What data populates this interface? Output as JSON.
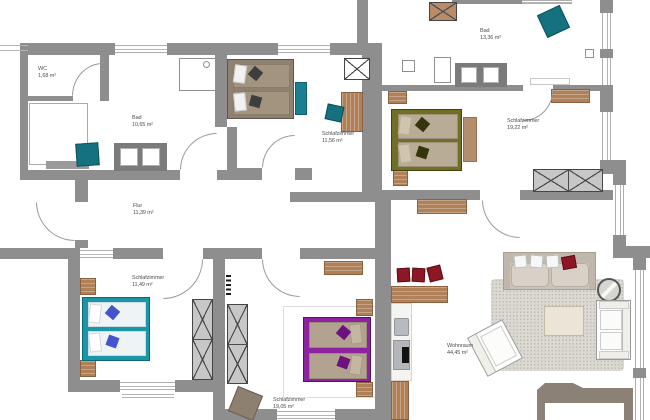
{
  "rooms": {
    "wc": {
      "name": "WC",
      "area": "1,68 m²"
    },
    "bad_left": {
      "name": "Bad",
      "area": "10,65 m²"
    },
    "schlaf_top": {
      "name": "Schlafzimmer",
      "area": "11,56 m²"
    },
    "flur": {
      "name": "Flur",
      "area": "11,39 m²"
    },
    "schlaf_bl": {
      "name": "Schlafzimmer",
      "area": "11,49 m²"
    },
    "schlaf_bm": {
      "name": "Schlafzimmer",
      "area": "19,05 m²"
    },
    "bad_right": {
      "name": "Bad",
      "area": "13,36 m²"
    },
    "schlaf_right": {
      "name": "Schlafzimmer",
      "area": "19,22 m²"
    },
    "wohnraum": {
      "name": "Wohnraum",
      "area": "44,45 m²"
    }
  },
  "palette": {
    "wall": "#8e8e8e",
    "teal_accent": "#16717f",
    "bed_teal": "#1c95a6",
    "bed_olive": "#6f7026",
    "bed_purple": "#8d23a0",
    "bed_brown": "#8f8172",
    "red_accent": "#8d1724",
    "wood": "#b08159",
    "parapet_taupe": "#8b8177"
  }
}
